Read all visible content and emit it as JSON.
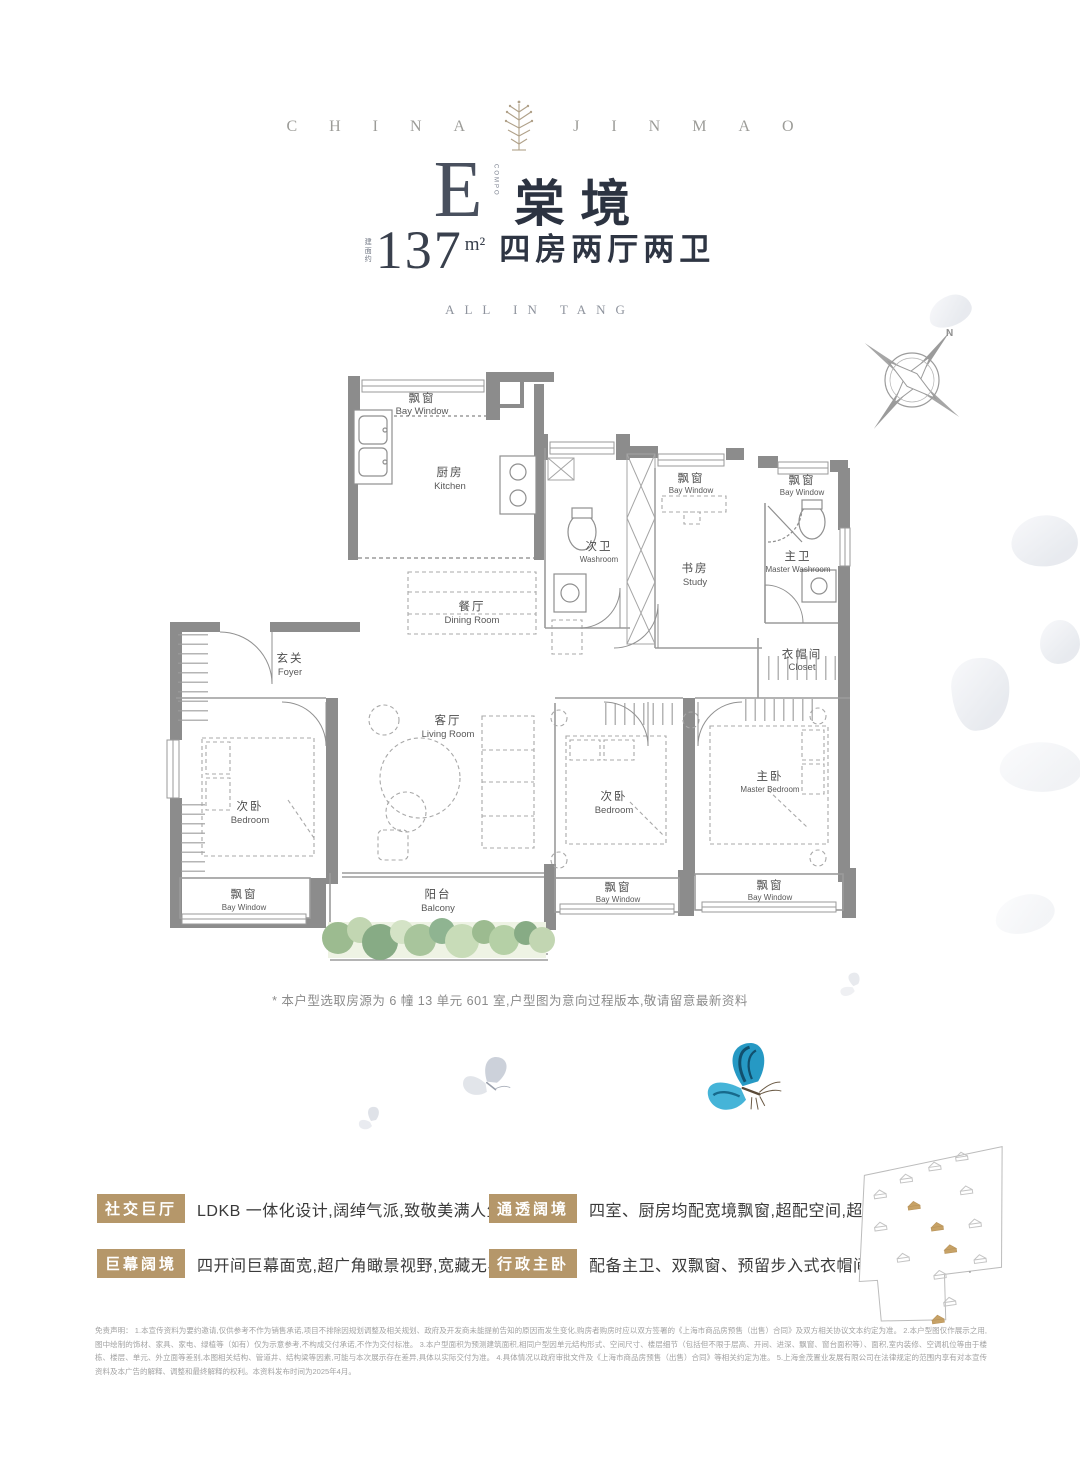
{
  "brand": {
    "left": "CHINA",
    "right": "JINMAO"
  },
  "header": {
    "type_letter": "E",
    "type_vertical": "COMPO",
    "title": "棠境",
    "area_prefix": "建面约",
    "area_value": "137",
    "area_unit": "m²",
    "layout_text": "四房两厅两卫",
    "subtitle": "ALL IN TANG"
  },
  "floorplan": {
    "compass_label": "N",
    "note": "* 本户型选取房源为 6 幢 13 单元 601 室,户型图为意向过程版本,敬请留意最新资料",
    "rooms": [
      {
        "cn": "飘窗",
        "en": "Bay Window"
      },
      {
        "cn": "厨房",
        "en": "Kitchen"
      },
      {
        "cn": "次卫",
        "en": "Washroom"
      },
      {
        "cn": "餐厅",
        "en": "Dining Room"
      },
      {
        "cn": "飘窗",
        "en": "Bay Window"
      },
      {
        "cn": "书房",
        "en": "Study"
      },
      {
        "cn": "飘窗",
        "en": "Bay Window"
      },
      {
        "cn": "主卫",
        "en": "Master Washroom"
      },
      {
        "cn": "衣帽间",
        "en": "Closet"
      },
      {
        "cn": "玄关",
        "en": "Foyer"
      },
      {
        "cn": "客厅",
        "en": "Living Room"
      },
      {
        "cn": "次卧",
        "en": "Bedroom"
      },
      {
        "cn": "飘窗",
        "en": "Bay Window"
      },
      {
        "cn": "阳台",
        "en": "Balcony"
      },
      {
        "cn": "次卧",
        "en": "Bedroom"
      },
      {
        "cn": "主卧",
        "en": "Master Bedroom"
      },
      {
        "cn": "飘窗",
        "en": "Bay Window"
      },
      {
        "cn": "飘窗",
        "en": "Bay Window"
      }
    ]
  },
  "features": [
    {
      "badge": "社交巨厅",
      "text": "LDKB 一体化设计,阔绰气派,致敬美满人生"
    },
    {
      "badge": "通透阔境",
      "text": "四室、厨房均配宽境飘窗,超配空间,超越所享"
    },
    {
      "badge": "巨幕阔境",
      "text": "四开间巨幕面宽,超广角瞰景视野,宽藏无界风光"
    },
    {
      "badge": "行政主卧",
      "text": "配备主卫、双飘窗、预留步入式衣帽间空间,尊崇私密"
    }
  ],
  "disclaimer": "免责声明： 1.本宣传资料为要约邀请,仅供参考不作为销售承诺,项目不排除因规划调整及相关规划、政府及开发商未能提前告知的原因而发生变化,购房者购房时应以双方签署的《上海市商品房预售（出售）合同》及双方相关协议文本约定为准。 2.本户型图仅作展示之用,图中绘制的饰材、家具、家电、绿植等（如有）仅为示意参考,不构成交付承诺,不作为交付标准。 3.本户型面积为预测建筑面积,相同户型因单元结构形式、空间尺寸、楼层细节（包括但不限于层高、开间、进深、飘窗、窗台面积等）、面积,室内装修、空调机位等由于楼栋、楼层、单元、外立面等差别,本图相关结构、管道井、结构梁等因素,可能与本次展示存在差异,具体以实际交付为准。 4.具体情况以政府审批文件及《上海市商品房预售（出售）合同》等相关约定为准。 5.上海金茂置业发展有限公司在法律规定的范围内享有对本宣传资料及本广告的解释、调整和最终解释的权利。本资料发布时间为2025年4月。",
  "colors": {
    "badge": "#b5976a",
    "wall": "#8c8c8c",
    "title": "#2c3341",
    "butterfly_blue": "#2699c4",
    "greenery": "#9cbb90"
  }
}
